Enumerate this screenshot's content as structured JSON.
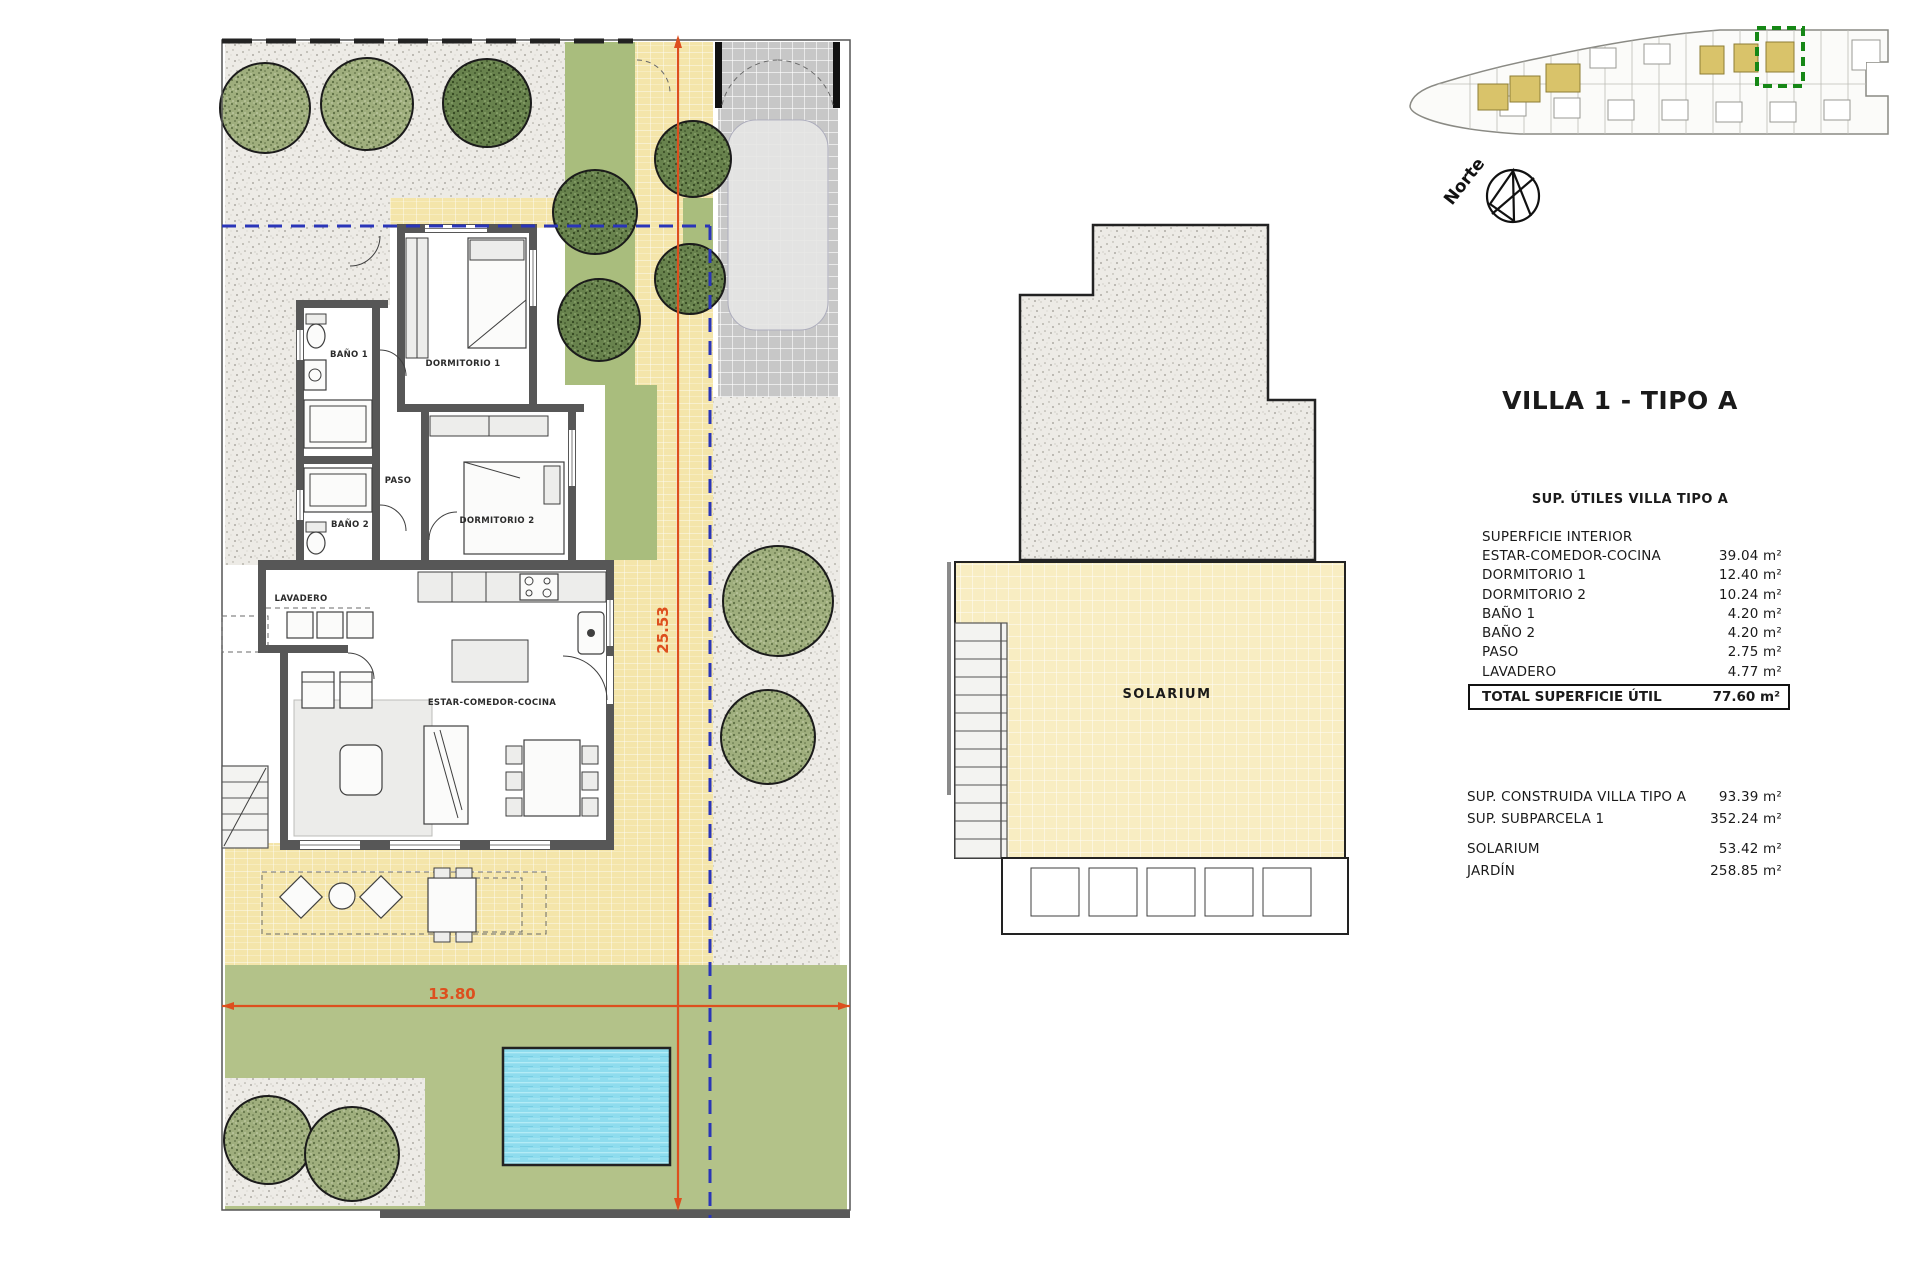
{
  "title": "VILLA 1 - TIPO A",
  "areas_table": {
    "header": "SUP. ÚTILES VILLA TIPO A",
    "section_label": "SUPERFICIE INTERIOR",
    "rows": [
      {
        "label": "ESTAR-COMEDOR-COCINA",
        "value": "39.04 m²"
      },
      {
        "label": "DORMITORIO 1",
        "value": "12.40 m²"
      },
      {
        "label": "DORMITORIO 2",
        "value": "10.24 m²"
      },
      {
        "label": "BAÑO 1",
        "value": "4.20 m²"
      },
      {
        "label": "BAÑO 2",
        "value": "4.20 m²"
      },
      {
        "label": "PASO",
        "value": "2.75 m²"
      },
      {
        "label": "LAVADERO",
        "value": "4.77 m²"
      }
    ],
    "total": {
      "label": "TOTAL SUPERFICIE ÚTIL",
      "value": "77.60 m²"
    }
  },
  "summary_table": {
    "rows": [
      {
        "label": "SUP. CONSTRUIDA VILLA TIPO A",
        "value": "93.39 m²"
      },
      {
        "label": "SUP. SUBPARCELA 1",
        "value": "352.24 m²"
      },
      {
        "label": "SOLARIUM",
        "value": "53.42 m²"
      },
      {
        "label": "JARDÍN",
        "value": "258.85 m²"
      }
    ]
  },
  "floor_plan": {
    "labels": {
      "bano1": "BAÑO 1",
      "dormitorio1": "DORMITORIO 1",
      "paso": "PASO",
      "bano2": "BAÑO 2",
      "dormitorio2": "DORMITORIO 2",
      "lavadero": "LAVADERO",
      "estar": "ESTAR-COMEDOR-COCINA"
    },
    "dimensions": {
      "plot_width_label": "13.80",
      "plot_height_label": "25.53"
    }
  },
  "solarium_plan": {
    "label": "SOLARIUM"
  },
  "compass": {
    "label": "Norte"
  },
  "colors": {
    "accent_orange": "#dd4f1e",
    "dashed_blue": "#2a35b8",
    "garden_green": "#b3c289",
    "strip_green": "#a9bd7d",
    "pool_blue": "#8edcee",
    "tile_yellow": "#f4e5aa",
    "solarium_yellow": "#f8edc2",
    "wall_gray": "#575757",
    "highlight_green": "#168716",
    "site_villa_yellow": "#d9c36a"
  }
}
